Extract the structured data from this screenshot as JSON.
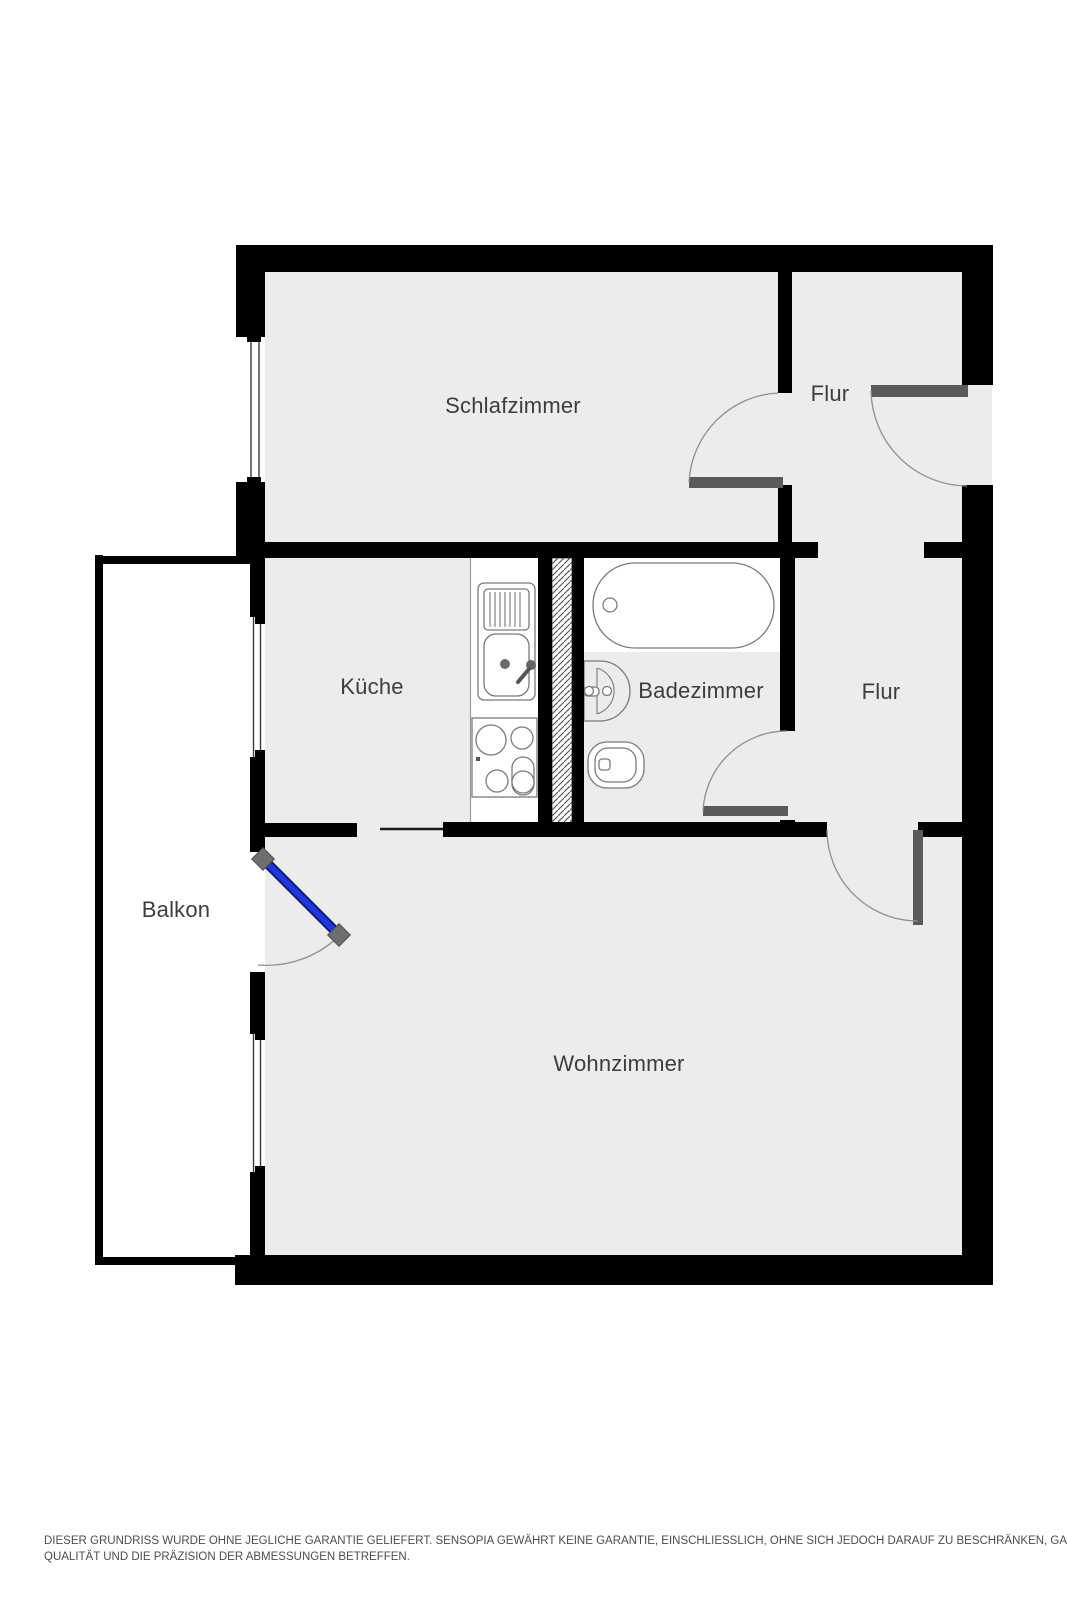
{
  "rooms": {
    "schlafzimmer": "Schlafzimmer",
    "flur_top": "Flur",
    "kueche": "Küche",
    "badezimmer": "Badezimmer",
    "flur_right": "Flur",
    "balkon": "Balkon",
    "wohnzimmer": "Wohnzimmer"
  },
  "disclaimer": {
    "line1": "DIESER GRUNDRISS WURDE OHNE JEGLICHE GARANTIE GELIEFERT. SENSOPIA GEWÄHRT KEINE GARANTIE, EINSCHLIESSLICH, OHNE SICH JEDOCH DARAUF ZU BESCHRÄNKEN, GARANTIEN, DIE DIE",
    "line2": "QUALITÄT UND DIE PRÄZISION DER ABMESSUNGEN BETREFFEN."
  },
  "fixtures": [
    "bathtub",
    "bathroom-sink",
    "toilet",
    "kitchen-sink-unit",
    "cooktop",
    "kitchen-counter",
    "ventilation-shaft",
    "balcony-door",
    "entrance-door",
    "interior-door",
    "window"
  ],
  "colors": {
    "wall": "#000000",
    "floor": "#ececec",
    "door_leaf": "#5a5a5a",
    "balcony_door_blue": "#1c39e0",
    "balcony_door_edge": "#0d1a6e",
    "door_arc": "#8f8f8f",
    "fixture_outline": "#7a7a7a",
    "label_text": "#3d3d3d",
    "disclaimer_text": "#4d4d4d",
    "handle_gray": "#6e6e6e"
  }
}
